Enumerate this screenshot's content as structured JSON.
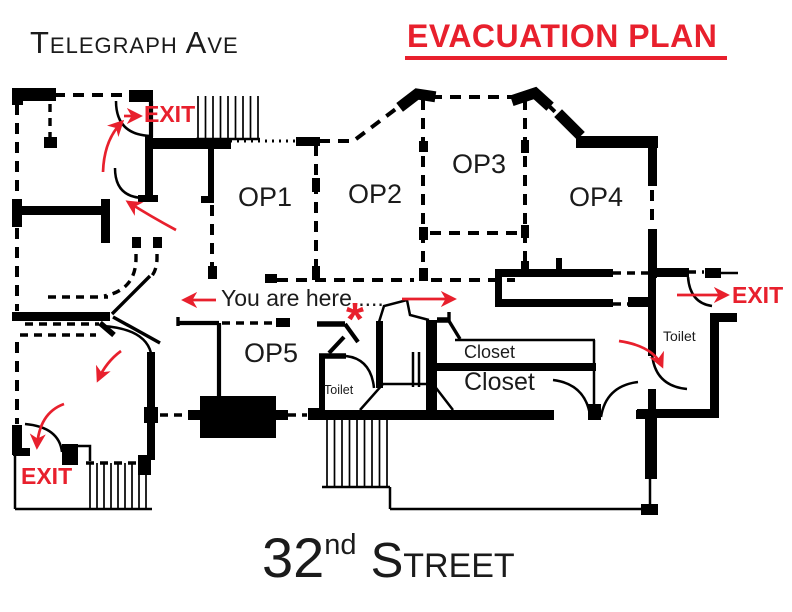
{
  "header": {
    "street_top_label": "Telegraph Ave",
    "title": "EVACUATION PLAN"
  },
  "footer": {
    "street_number": "32",
    "street_ordinal": "nd",
    "street_word": "Street"
  },
  "rooms": {
    "op1": "OP1",
    "op2": "OP2",
    "op3": "OP3",
    "op4": "OP4",
    "op5": "OP5"
  },
  "annotations": {
    "you_are_here": "You are here.....",
    "location_marker": "*"
  },
  "facilities": {
    "toilet_center": "Toilet",
    "toilet_right": "Toilet",
    "closet_upper": "Closet",
    "closet_lower": "Closet"
  },
  "exits": {
    "top_left": "EXIT",
    "bottom_left": "EXIT",
    "right": "EXIT"
  },
  "colors": {
    "accent_red": "#e8202d",
    "wall_black": "#000000",
    "text_ink": "#1b1b1b"
  }
}
